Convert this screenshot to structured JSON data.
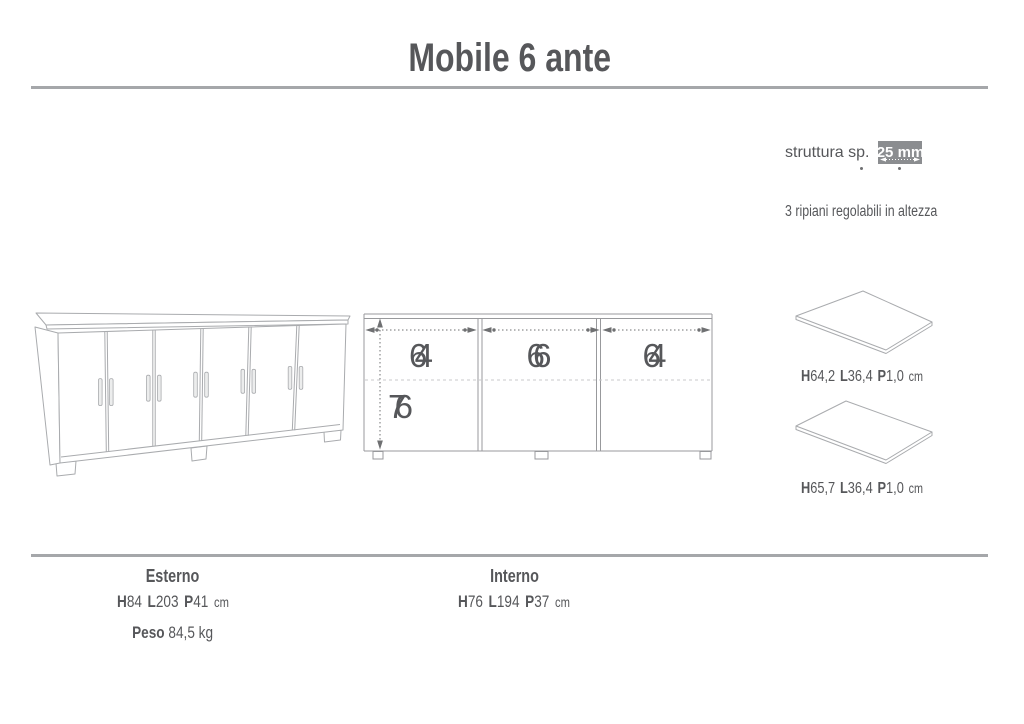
{
  "title": "Mobile 6 ante",
  "colors": {
    "ink": "#56575a",
    "rule": "#a5a7aa",
    "spec_box_bg": "#8b8d90",
    "drawing_stroke": "#a9abae",
    "dimension_stroke": "#6f7072"
  },
  "specs": {
    "struttura": {
      "label": "struttura sp.",
      "value": "25 mm"
    },
    "shelves_note": "3 ripiani regolabili in altezza"
  },
  "interior_diagram": {
    "width_left": "64",
    "width_middle": "66",
    "width_right": "64",
    "height": "76"
  },
  "shelf_panels": [
    {
      "h_key": "H",
      "h": "64,2",
      "l_key": "L",
      "l": "36,4",
      "p_key": "P",
      "p": "1,0",
      "unit": "cm"
    },
    {
      "h_key": "H",
      "h": "65,7",
      "l_key": "L",
      "l": "36,4",
      "p_key": "P",
      "p": "1,0",
      "unit": "cm"
    }
  ],
  "legend": {
    "esterno": {
      "heading": "Esterno",
      "h_key": "H",
      "h": "84",
      "l_key": "L",
      "l": "203",
      "p_key": "P",
      "p": "41",
      "unit": "cm",
      "peso_key": "Peso",
      "peso": "84,5 kg"
    },
    "interno": {
      "heading": "Interno",
      "h_key": "H",
      "h": "76",
      "l_key": "L",
      "l": "194",
      "p_key": "P",
      "p": "37",
      "unit": "cm"
    }
  }
}
